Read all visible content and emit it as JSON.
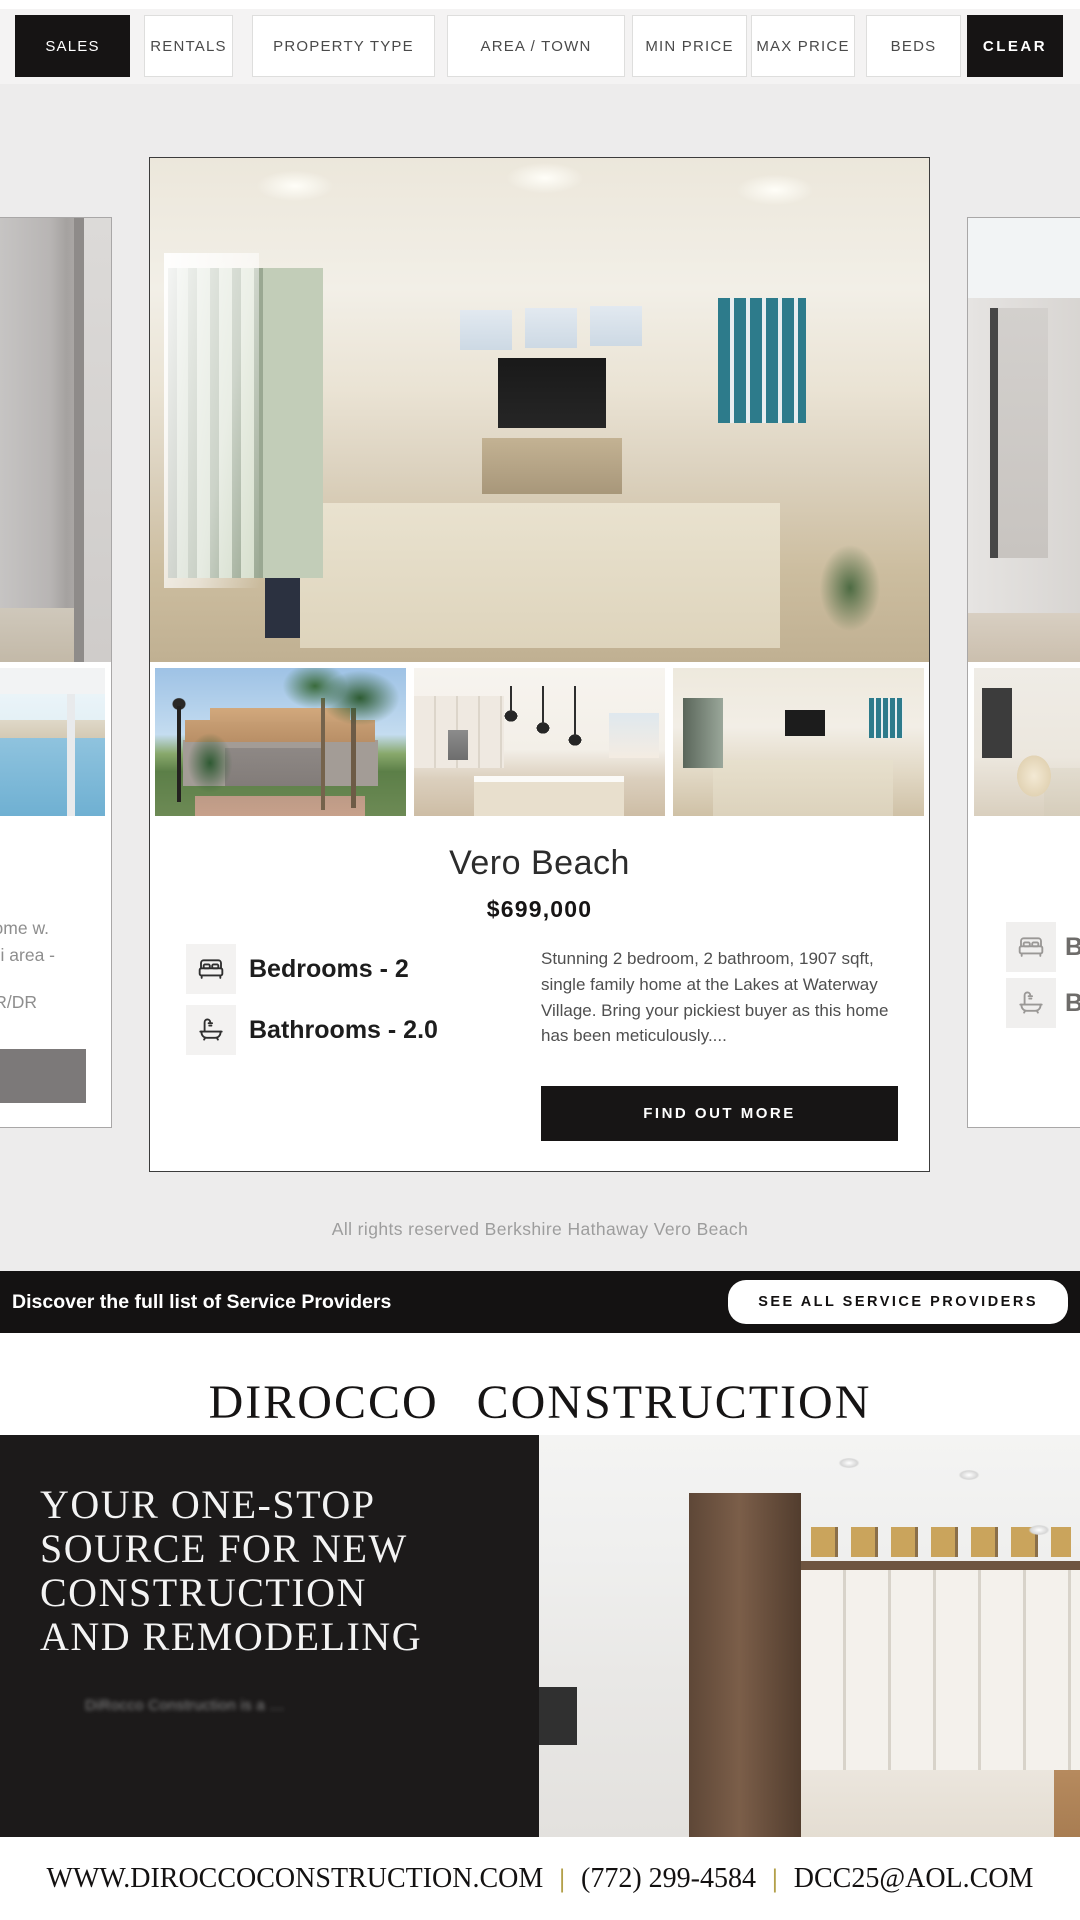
{
  "filter_bar": {
    "items": [
      {
        "label": "SALES",
        "active": true
      },
      {
        "label": "RENTALS",
        "active": false
      },
      {
        "label": "PROPERTY TYPE",
        "active": false
      },
      {
        "label": "AREA / TOWN",
        "active": false
      },
      {
        "label": "MIN PRICE",
        "active": false
      },
      {
        "label": "MAX PRICE",
        "active": false
      },
      {
        "label": "BEDS",
        "active": false
      },
      {
        "label": "CLEAR",
        "active": true
      }
    ]
  },
  "listing": {
    "city": "Vero Beach",
    "price": "$699,000",
    "features": [
      {
        "icon": "bed-icon",
        "label": "Bedrooms - 2"
      },
      {
        "icon": "bath-icon",
        "label": "Bathrooms - 2.0"
      }
    ],
    "description": "Stunning 2 bedroom, 2 bathroom, 1907 sqft, single family home at the Lakes at Waterway Village. Bring your pickiest buyer as this home has been meticulously....",
    "cta_label": "FIND OUT MORE"
  },
  "prev_card": {
    "text_line1": "ome w.",
    "text_line2": "i area -",
    "text_line3": "R/DR"
  },
  "next_card": {
    "feature1": "Be",
    "feature2": "Ba"
  },
  "copyright": "All rights reserved Berkshire Hathaway Vero Beach",
  "service_bar": {
    "text": "Discover the full list of Service Providers",
    "button_label": "SEE ALL SERVICE PROVIDERS"
  },
  "sponsor": {
    "name": "DIROCCO CONSTRUCTION",
    "headline_lines": [
      "YOUR ONE-STOP",
      "SOURCE FOR NEW",
      "CONSTRUCTION",
      "AND REMODELING"
    ],
    "subtext": "DiRocco Construction is a …",
    "website": "WWW.DIROCCOCONSTRUCTION.COM",
    "phone": "(772) 299-4584",
    "email": "DCC25@AOL.COM",
    "separator": "|"
  },
  "colors": {
    "accent_black": "#161414",
    "gold": "#b3a04a",
    "page_bg": "#edecec"
  }
}
